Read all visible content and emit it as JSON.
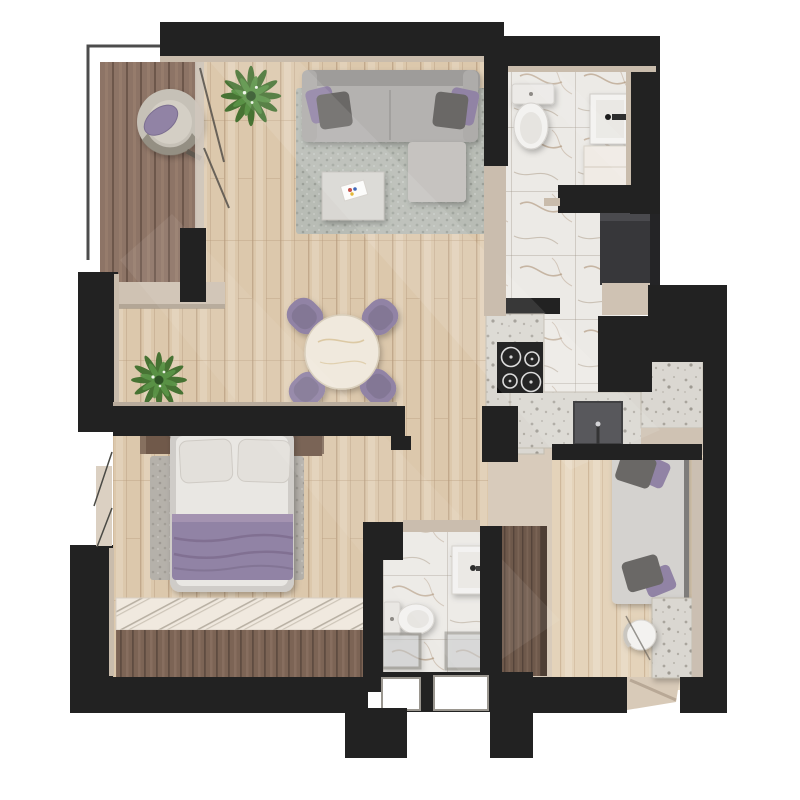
{
  "scene": {
    "kind": "architectural-floor-plan",
    "view": "top-down-3d-render",
    "background": "#ffffff"
  },
  "palette": {
    "wall": "#222222",
    "wall_face": "#cabdae",
    "wood_base": "#dcc8ac",
    "wood_light": "#e4d3ba",
    "deck": "#8d7466",
    "deck_dark": "#7c6455",
    "marble": "#eceae6",
    "terrazzo": "#dad7d1",
    "entry_floor": "#d8cbbb",
    "rug_gray": "#b8bcb5",
    "rug_warm": "#b5b1aa",
    "sofa_gray": "#b4b2b0",
    "cushion_gray": "#6a6866",
    "accent_purple": "#9183a5",
    "purple_deep": "#7e6d8e",
    "plant_green": "#41702f",
    "plant_light": "#5a9347",
    "fixture_white": "#f3f2f0",
    "wardrobe_wood": "#6e594b",
    "bed_wood": "#86705f",
    "appliance_black": "#0d0d0d",
    "fridge_gray": "#37373a",
    "glass": "#cfd2d4"
  },
  "rooms": [
    {
      "id": "balcony",
      "name": "Balcony",
      "floor": "wood-deck",
      "items": [
        "lounge-chair",
        "glass-railing"
      ]
    },
    {
      "id": "living-room",
      "name": "Living room",
      "floor": "light-wood-plank",
      "items": [
        "sofa",
        "two-accent-pillows",
        "ottoman",
        "area-rug",
        "coffee-table",
        "book",
        "potted-plant",
        "sliding-glass-door"
      ]
    },
    {
      "id": "dining-area",
      "name": "Dining area",
      "floor": "light-wood-plank",
      "items": [
        "round-marble-table",
        "dining-chair-nw",
        "dining-chair-ne",
        "dining-chair-sw",
        "dining-chair-se",
        "potted-plant"
      ]
    },
    {
      "id": "kitchen",
      "name": "Kitchen",
      "floor": "marble-tile",
      "items": [
        "counter-left",
        "counter-bottom",
        "backsplash-wall",
        "cooktop-four-burners",
        "kitchen-sink",
        "tall-fridge-unit",
        "peninsula-counter"
      ]
    },
    {
      "id": "bathroom-main",
      "name": "Bathroom (top)",
      "floor": "marble-tile",
      "items": [
        "toilet",
        "wall-sink",
        "vanity-cabinet"
      ]
    },
    {
      "id": "shower-room",
      "name": "Shower room (bottom)",
      "floor": "marble-tile",
      "items": [
        "toilet",
        "wall-sink",
        "shower-glass-panel-left",
        "shower-glass-panel-right",
        "window-pair"
      ]
    },
    {
      "id": "bedroom",
      "name": "Bedroom",
      "floor": "light-wood-plank",
      "items": [
        "double-bed",
        "pillow-left",
        "pillow-right",
        "purple-blanket",
        "headboard",
        "nightstand-left",
        "nightstand-right",
        "area-rug",
        "window-bench",
        "open-window"
      ]
    },
    {
      "id": "hallway",
      "name": "Hallway / entry",
      "floor": "stone",
      "items": [
        "wardrobe",
        "entry-door-opening"
      ]
    },
    {
      "id": "study-nook",
      "name": "Study nook",
      "floor": "light-wood-plank",
      "items": [
        "daybed",
        "cushion-top-pair",
        "cushion-bottom-pair",
        "terrazzo-desk",
        "round-chair"
      ]
    }
  ],
  "counts": {
    "dining_chairs": 4,
    "cooktop_burners": 4,
    "bed_pillows": 2,
    "plants": 2,
    "bathrooms": 2
  }
}
